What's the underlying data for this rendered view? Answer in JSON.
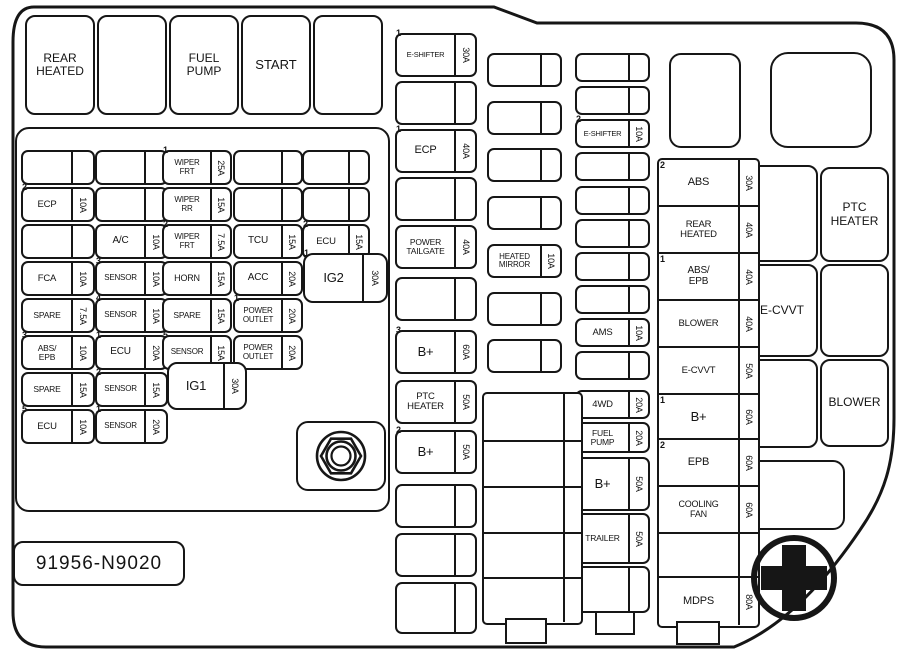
{
  "part_number": "91956-N9020",
  "colors": {
    "line": "#161616",
    "background": "#ffffff"
  },
  "plain_boxes": [
    {
      "name": "relay-rear-heated",
      "x": 25,
      "y": 15,
      "w": 70,
      "h": 100,
      "r": 10,
      "label": "REAR\nHEATED",
      "fs": 12
    },
    {
      "name": "relay-blank-1",
      "x": 97,
      "y": 15,
      "w": 70,
      "h": 100,
      "r": 10,
      "label": ""
    },
    {
      "name": "relay-fuel-pump",
      "x": 169,
      "y": 15,
      "w": 70,
      "h": 100,
      "r": 10,
      "label": "FUEL\nPUMP",
      "fs": 12
    },
    {
      "name": "relay-start",
      "x": 241,
      "y": 15,
      "w": 70,
      "h": 100,
      "r": 10,
      "label": "START",
      "fs": 13
    },
    {
      "name": "relay-blank-2",
      "x": 313,
      "y": 15,
      "w": 70,
      "h": 100,
      "r": 10,
      "label": ""
    },
    {
      "name": "left-fuse-frame",
      "x": 15,
      "y": 127,
      "w": 375,
      "h": 385,
      "r": 14,
      "label": ""
    },
    {
      "name": "nut-housing",
      "x": 296,
      "y": 421,
      "w": 90,
      "h": 70,
      "r": 12,
      "label": ""
    },
    {
      "name": "relay-blank-top-right",
      "x": 669,
      "y": 53,
      "w": 72,
      "h": 95,
      "r": 12,
      "label": ""
    },
    {
      "name": "relay-blank-square",
      "x": 770,
      "y": 52,
      "w": 102,
      "h": 96,
      "r": 18,
      "label": ""
    },
    {
      "name": "relay-blank-right-1",
      "x": 746,
      "y": 165,
      "w": 72,
      "h": 97,
      "r": 10,
      "label": ""
    },
    {
      "name": "relay-ptc-heater",
      "x": 820,
      "y": 167,
      "w": 69,
      "h": 95,
      "r": 10,
      "label": "PTC\nHEATER",
      "fs": 12
    },
    {
      "name": "relay-e-cvvt",
      "x": 746,
      "y": 264,
      "w": 72,
      "h": 93,
      "r": 10,
      "label": "E-CVVT",
      "fs": 12
    },
    {
      "name": "relay-blank-right-2",
      "x": 820,
      "y": 264,
      "w": 69,
      "h": 93,
      "r": 10,
      "label": ""
    },
    {
      "name": "relay-blank-right-3",
      "x": 746,
      "y": 359,
      "w": 72,
      "h": 89,
      "r": 10,
      "label": ""
    },
    {
      "name": "relay-blower",
      "x": 820,
      "y": 359,
      "w": 69,
      "h": 88,
      "r": 10,
      "label": "BLOWER",
      "fs": 12
    },
    {
      "name": "relay-blank-bottom-right",
      "x": 748,
      "y": 460,
      "w": 97,
      "h": 70,
      "r": 12,
      "label": ""
    }
  ],
  "fuse_groups": [
    {
      "name": "left-col-a",
      "x": 21,
      "w": 74,
      "h": 35,
      "amp_w": 22,
      "fs": 9.5,
      "rows_y": [
        150,
        187,
        224,
        261,
        298,
        335,
        372,
        409
      ],
      "items": [
        {
          "label": "",
          "amp": ""
        },
        {
          "label": "ECP",
          "amp": "10A",
          "mark": "2"
        },
        {
          "label": "",
          "amp": ""
        },
        {
          "label": "FCA",
          "amp": "10A"
        },
        {
          "label": "SPARE",
          "amp": "7.5A",
          "fs": 8.5
        },
        {
          "label": "ABS/\nEPB",
          "amp": "10A",
          "mark": "3",
          "fs": 8.5
        },
        {
          "label": "SPARE",
          "amp": "15A",
          "fs": 8.5
        },
        {
          "label": "ECU",
          "amp": "10A",
          "mark": "5"
        }
      ]
    },
    {
      "name": "left-col-b",
      "x": 95,
      "w": 73,
      "h": 35,
      "amp_w": 22,
      "fs": 8.5,
      "rows_y": [
        150,
        187,
        224,
        261,
        298,
        335,
        372,
        409
      ],
      "items": [
        {
          "label": "",
          "amp": ""
        },
        {
          "label": "",
          "amp": ""
        },
        {
          "label": "A/C",
          "amp": "10A",
          "fs": 10
        },
        {
          "label": "SENSOR",
          "amp": "10A",
          "mark": "3",
          "fs": 8
        },
        {
          "label": "SENSOR",
          "amp": "10A",
          "mark": "4",
          "fs": 8
        },
        {
          "label": "ECU",
          "amp": "20A",
          "mark": "1",
          "fs": 10
        },
        {
          "label": "SENSOR",
          "amp": "15A",
          "mark": "2",
          "fs": 8
        },
        {
          "label": "SENSOR",
          "amp": "20A",
          "mark": "1",
          "fs": 8
        }
      ]
    },
    {
      "name": "left-col-c",
      "x": 162,
      "w": 70,
      "h": 35,
      "amp_w": 20,
      "fs": 8,
      "rows_y": [
        150,
        187,
        224,
        261,
        298,
        335
      ],
      "items": [
        {
          "label": "WIPER\nFRT",
          "amp": "25A",
          "mark": "1"
        },
        {
          "label": "WIPER\nRR",
          "amp": "15A"
        },
        {
          "label": "WIPER\nFRT",
          "amp": "7.5A",
          "mark": "2"
        },
        {
          "label": "HORN",
          "amp": "15A",
          "fs": 9
        },
        {
          "label": "SPARE",
          "amp": "15A",
          "fs": 8.5
        },
        {
          "label": "SENSOR",
          "amp": "15A",
          "mark": "5"
        }
      ]
    },
    {
      "name": "left-col-d",
      "x": 233,
      "w": 70,
      "h": 35,
      "amp_w": 20,
      "fs": 8,
      "rows_y": [
        150,
        187,
        224,
        261,
        298,
        335
      ],
      "items": [
        {
          "label": "",
          "amp": ""
        },
        {
          "label": "",
          "amp": ""
        },
        {
          "label": "TCU",
          "amp": "15A",
          "fs": 10
        },
        {
          "label": "ACC",
          "amp": "20A",
          "fs": 10
        },
        {
          "label": "POWER\nOUTLET",
          "amp": "20A",
          "mark": "1"
        },
        {
          "label": "POWER\nOUTLET",
          "amp": "20A"
        }
      ]
    },
    {
      "name": "left-col-e",
      "x": 302,
      "w": 68,
      "h": 35,
      "amp_w": 20,
      "fs": 9.5,
      "rows_y": [
        150,
        187,
        224
      ],
      "items": [
        {
          "label": "",
          "amp": ""
        },
        {
          "label": "",
          "amp": ""
        },
        {
          "label": "ECU",
          "amp": "15A",
          "mark": "2"
        }
      ]
    },
    {
      "name": "ig2",
      "x": 303,
      "w": 85,
      "h": 50,
      "amp_w": 24,
      "r": 10,
      "fs": 13,
      "rows_y": [
        253
      ],
      "items": [
        {
          "label": "IG2",
          "amp": "30A",
          "mark": "1"
        }
      ]
    },
    {
      "name": "ig1",
      "x": 167,
      "w": 80,
      "h": 48,
      "amp_w": 22,
      "r": 10,
      "fs": 13,
      "rows_y": [
        362
      ],
      "items": [
        {
          "label": "IG1",
          "amp": "30A"
        }
      ]
    },
    {
      "name": "mid-col-1",
      "x": 395,
      "w": 82,
      "h": 44,
      "amp_w": 21,
      "fs": 9,
      "rows_y": [
        33,
        81,
        129,
        177,
        225,
        277,
        330,
        380,
        430,
        484,
        533,
        582
      ],
      "items": [
        {
          "label": "E-SHIFTER",
          "amp": "30A",
          "mark": "1",
          "fs": 7.5
        },
        {
          "label": "",
          "amp": ""
        },
        {
          "label": "ECP",
          "amp": "40A",
          "mark": "1",
          "fs": 11
        },
        {
          "label": "",
          "amp": ""
        },
        {
          "label": "POWER\nTAILGATE",
          "amp": "40A",
          "fs": 8.5
        },
        {
          "label": "",
          "amp": ""
        },
        {
          "label": "B+",
          "amp": "60A",
          "mark": "3",
          "fs": 13
        },
        {
          "label": "PTC\nHEATER",
          "amp": "50A",
          "fs": 9.5
        },
        {
          "label": "B+",
          "amp": "50A",
          "mark": "2",
          "fs": 13
        },
        {
          "label": "",
          "amp": ""
        },
        {
          "label": "",
          "amp": ""
        },
        {
          "label": "",
          "amp": "",
          "h": 52
        }
      ]
    },
    {
      "name": "mid-col-2",
      "x": 487,
      "w": 75,
      "h": 34,
      "amp_w": 20,
      "fs": 8,
      "rows_y": [
        53,
        101,
        148,
        196,
        244,
        292,
        339
      ],
      "items": [
        {
          "label": "",
          "amp": ""
        },
        {
          "label": "",
          "amp": ""
        },
        {
          "label": "",
          "amp": ""
        },
        {
          "label": "",
          "amp": ""
        },
        {
          "label": "HEATED\nMIRROR",
          "amp": "10A"
        },
        {
          "label": "",
          "amp": ""
        },
        {
          "label": "",
          "amp": ""
        }
      ]
    },
    {
      "name": "mid-col-3",
      "x": 575,
      "w": 75,
      "h": 29,
      "amp_w": 20,
      "fs": 7.5,
      "rows_y": [
        53,
        86,
        119,
        152,
        186,
        219,
        252,
        285,
        318,
        351
      ],
      "items": [
        {
          "label": "",
          "amp": ""
        },
        {
          "label": "",
          "amp": ""
        },
        {
          "label": "E-SHIFTER",
          "amp": "10A",
          "mark": "2"
        },
        {
          "label": "",
          "amp": ""
        },
        {
          "label": "",
          "amp": ""
        },
        {
          "label": "",
          "amp": ""
        },
        {
          "label": "",
          "amp": ""
        },
        {
          "label": "",
          "amp": ""
        },
        {
          "label": "AMS",
          "amp": "10A",
          "fs": 9.5
        },
        {
          "label": "",
          "amp": ""
        }
      ]
    },
    {
      "name": "mid-col-3-lower",
      "x": 575,
      "w": 75,
      "h": 29,
      "amp_w": 20,
      "fs": 9,
      "rows_y": [
        390,
        422,
        457,
        513,
        566
      ],
      "items": [
        {
          "label": "4WD",
          "amp": "20A",
          "fs": 9.5
        },
        {
          "label": "FUEL\nPUMP",
          "amp": "20A",
          "fs": 8.5,
          "h": 31
        },
        {
          "label": "B+",
          "amp": "50A",
          "mark": "4",
          "fs": 13,
          "h": 54
        },
        {
          "label": "TRAILER",
          "amp": "50A",
          "fs": 8.5,
          "h": 51
        },
        {
          "label": "",
          "amp": "",
          "h": 47
        }
      ]
    }
  ],
  "blocks": [
    {
      "name": "right-fuse-block",
      "x": 657,
      "y": 158,
      "w": 83,
      "amp_w": 20,
      "fs": 9.5,
      "rows": [
        {
          "label": "ABS",
          "amp": "30A",
          "mark": "2",
          "h": 45,
          "fs": 11
        },
        {
          "label": "REAR\nHEATED",
          "amp": "40A",
          "h": 47
        },
        {
          "label": "ABS/\nEPB",
          "amp": "40A",
          "mark": "1",
          "h": 47,
          "fs": 10
        },
        {
          "label": "BLOWER",
          "amp": "40A",
          "h": 47
        },
        {
          "label": "E-CVVT",
          "amp": "50A",
          "h": 47
        },
        {
          "label": "B+",
          "amp": "60A",
          "mark": "1",
          "h": 45,
          "fs": 13
        },
        {
          "label": "EPB",
          "amp": "60A",
          "mark": "2",
          "h": 47,
          "fs": 11
        },
        {
          "label": "COOLING\nFAN",
          "amp": "60A",
          "h": 47,
          "fs": 9
        },
        {
          "label": "",
          "amp": "",
          "h": 44
        },
        {
          "label": "MDPS",
          "amp": "80A",
          "h": 49,
          "fs": 11
        }
      ]
    },
    {
      "name": "center-bottom-block",
      "x": 482,
      "y": 392,
      "w": 83,
      "amp_w": 18,
      "fs": 9,
      "rows": [
        {
          "label": "",
          "amp": "",
          "h": 46
        },
        {
          "label": "",
          "amp": "",
          "h": 46
        },
        {
          "label": "",
          "amp": "",
          "h": 46
        },
        {
          "label": "",
          "amp": "",
          "h": 45
        },
        {
          "label": "",
          "amp": "",
          "h": 45
        }
      ]
    }
  ],
  "tabs": [
    {
      "name": "connector-tab-center",
      "x": 505,
      "y": 618,
      "w": 42,
      "h": 26
    },
    {
      "name": "connector-tab-mid",
      "x": 595,
      "y": 611,
      "w": 40,
      "h": 24
    },
    {
      "name": "connector-tab-right",
      "x": 676,
      "y": 621,
      "w": 44,
      "h": 24
    }
  ],
  "icons": {
    "nut": "hex-nut-icon",
    "battery_plus": "battery-positive-terminal-icon"
  }
}
